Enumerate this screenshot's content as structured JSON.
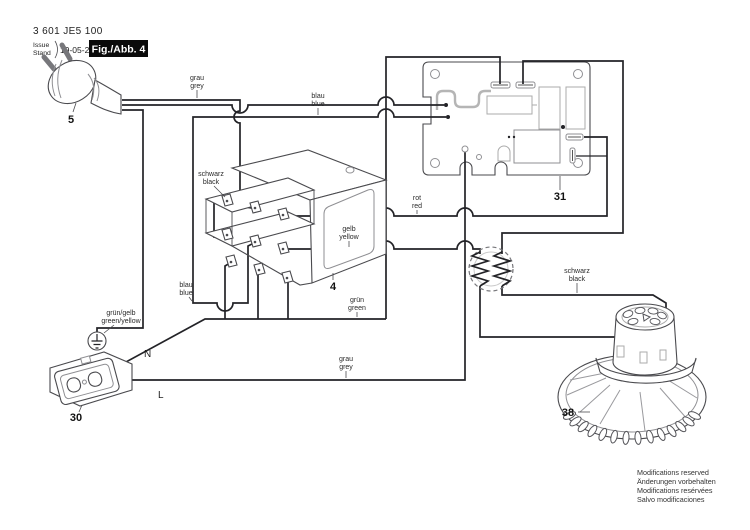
{
  "header": {
    "part_number": "3 601 JE5 100",
    "issue_line1": "Issue",
    "issue_line2": "Stand",
    "date": "19-05-29",
    "figure_label": "Fig./Abb. 4"
  },
  "callouts": {
    "plug": "5",
    "switch": "4",
    "pcb": "31",
    "socket": "30",
    "motor": "38"
  },
  "wire_labels": {
    "grau_top_1": "grau",
    "grau_top_2": "grey",
    "blau_top_1": "blau",
    "blau_top_2": "blue",
    "schwarz_switch_1": "schwarz",
    "schwarz_switch_2": "black",
    "gelb_1": "gelb",
    "gelb_2": "yellow",
    "rot_1": "rot",
    "rot_2": "red",
    "gruen_1": "grün",
    "gruen_2": "green",
    "blau_lower_1": "blau",
    "blau_lower_2": "blue",
    "gruen_gelb_1": "grün/gelb",
    "gruen_gelb_2": "green/yellow",
    "grau_bottom_1": "grau",
    "grau_bottom_2": "grey",
    "schwarz_motor_1": "schwarz",
    "schwarz_motor_2": "black",
    "neutral": "N",
    "live": "L"
  },
  "footer": {
    "line1": "Modifications reserved",
    "line2": "Änderungen vorbehalten",
    "line3": "Modifications resérvées",
    "line4": "Salvo modificaciones"
  },
  "colors": {
    "wire": "#232327",
    "outline": "#4a4a4e",
    "figure_box": "#0a0a0a"
  }
}
